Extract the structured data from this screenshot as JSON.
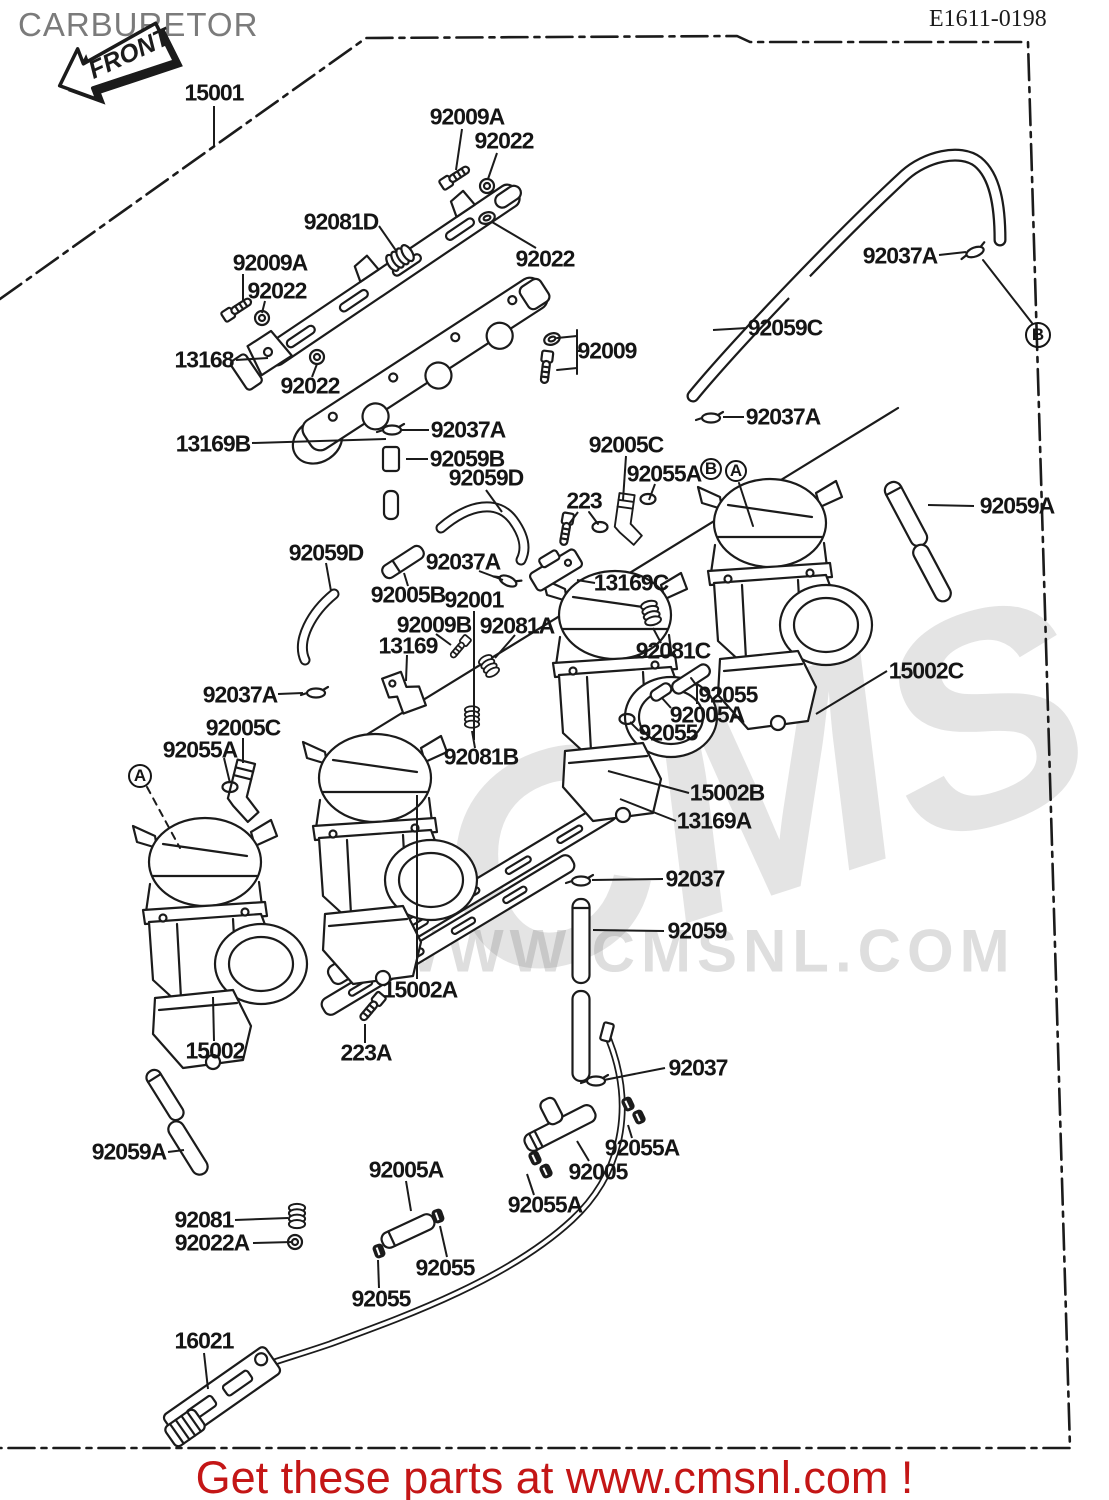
{
  "header": {
    "title": "CARBURETOR",
    "title_color": "#7b7b7b",
    "diagram_code": "E1611-0198"
  },
  "front_arrow": {
    "label": "FRONT"
  },
  "watermark": {
    "logo_text": "CMS",
    "url_text": "WWW.CMSNL.COM",
    "color": "#c9c9c9"
  },
  "footer": {
    "text": "Get these parts at www.cmsnl.com !",
    "color": "#c41616"
  },
  "colors": {
    "line": "#1b1b1b",
    "label": "#151515",
    "background": "#ffffff"
  },
  "diagram": {
    "reference_markers": [
      {
        "label": "A",
        "x": 140,
        "y": 776,
        "d": 24
      },
      {
        "label": "B",
        "x": 711,
        "y": 469,
        "d": 22
      },
      {
        "label": "A",
        "x": 736,
        "y": 471,
        "d": 22
      },
      {
        "label": "B",
        "x": 1038,
        "y": 335,
        "d": 26
      }
    ],
    "part_labels": [
      {
        "t": "15001",
        "x": 214,
        "y": 93,
        "l": [
          214,
          106,
          214,
          147
        ]
      },
      {
        "t": "92009A",
        "x": 467,
        "y": 117,
        "l": [
          462,
          129,
          456,
          170
        ]
      },
      {
        "t": "92022",
        "x": 504,
        "y": 141,
        "l": [
          497,
          153,
          488,
          179
        ]
      },
      {
        "t": "92022",
        "x": 545,
        "y": 259,
        "l": [
          536,
          248,
          492,
          222
        ]
      },
      {
        "t": "92081D",
        "x": 341,
        "y": 222,
        "l": [
          379,
          226,
          397,
          252
        ]
      },
      {
        "t": "92009A",
        "x": 270,
        "y": 263,
        "l": [
          243,
          274,
          243,
          302
        ]
      },
      {
        "t": "92022",
        "x": 277,
        "y": 291,
        "l": [
          265,
          301,
          262,
          313
        ]
      },
      {
        "t": "13168",
        "x": 204,
        "y": 360,
        "l": [
          236,
          360,
          268,
          358
        ]
      },
      {
        "t": "92022",
        "x": 310,
        "y": 386,
        "l": [
          312,
          377,
          317,
          364
        ]
      },
      {
        "t": "13169B",
        "x": 213,
        "y": 444,
        "l": [
          252,
          443,
          386,
          439
        ]
      },
      {
        "t": "92009",
        "x": 607,
        "y": 351,
        "l": [
          581,
          351,
          577,
          351
        ]
      },
      {
        "t": "92037A",
        "x": 468,
        "y": 430,
        "l": [
          429,
          430,
          401,
          430
        ]
      },
      {
        "t": "92059B",
        "x": 467,
        "y": 459,
        "l": [
          428,
          459,
          406,
          459
        ]
      },
      {
        "t": "92059D",
        "x": 486,
        "y": 478,
        "l": [
          486,
          490,
          502,
          512
        ]
      },
      {
        "t": "223",
        "x": 584,
        "y": 501,
        "l": [
          578,
          512,
          569,
          524
        ]
      },
      {
        "t": "92059D",
        "x": 326,
        "y": 553,
        "l": [
          326,
          563,
          331,
          591
        ]
      },
      {
        "t": "92037A",
        "x": 463,
        "y": 562,
        "l": [
          479,
          571,
          503,
          580
        ]
      },
      {
        "t": "92005B",
        "x": 408,
        "y": 595,
        "l": [
          408,
          586,
          404,
          573
        ]
      },
      {
        "t": "92001",
        "x": 474,
        "y": 600,
        "l": [
          474,
          611,
          474,
          740
        ]
      },
      {
        "t": "92009B",
        "x": 434,
        "y": 625,
        "l": [
          436,
          634,
          451,
          645
        ]
      },
      {
        "t": "92081A",
        "x": 517,
        "y": 626,
        "l": [
          515,
          635,
          495,
          658
        ]
      },
      {
        "t": "13169",
        "x": 408,
        "y": 646,
        "l": [
          407,
          655,
          406,
          681
        ]
      },
      {
        "t": "92081C",
        "x": 673,
        "y": 651,
        "l": [
          661,
          643,
          653,
          628
        ]
      },
      {
        "t": "92055",
        "x": 728,
        "y": 695,
        "l": [
          697,
          704,
          697,
          686
        ]
      },
      {
        "t": "92005A",
        "x": 707,
        "y": 715,
        "l": [
          671,
          708,
          662,
          698
        ]
      },
      {
        "t": "92055",
        "x": 668,
        "y": 733,
        "l": [
          639,
          731,
          630,
          722
        ]
      },
      {
        "t": "92081B",
        "x": 481,
        "y": 757,
        "l": [
          475,
          748,
          472,
          731
        ]
      },
      {
        "t": "15002B",
        "x": 727,
        "y": 793,
        "l": [
          689,
          793,
          608,
          771
        ]
      },
      {
        "t": "13169A",
        "x": 714,
        "y": 821,
        "l": [
          676,
          821,
          620,
          799
        ]
      },
      {
        "t": "92037",
        "x": 695,
        "y": 879,
        "l": [
          663,
          879,
          592,
          880
        ]
      },
      {
        "t": "92059",
        "x": 697,
        "y": 931,
        "l": [
          664,
          931,
          593,
          930
        ]
      },
      {
        "t": "15002A",
        "x": 420,
        "y": 990,
        "l": [
          417,
          979,
          417,
          795
        ]
      },
      {
        "t": "92037A",
        "x": 240,
        "y": 695,
        "l": [
          278,
          694,
          303,
          693
        ]
      },
      {
        "t": "92005C",
        "x": 243,
        "y": 728,
        "l": [
          243,
          738,
          243,
          763
        ]
      },
      {
        "t": "92055A",
        "x": 200,
        "y": 750,
        "l": [
          224,
          758,
          230,
          783
        ]
      },
      {
        "t": "15002",
        "x": 215,
        "y": 1051,
        "l": [
          214,
          1041,
          213,
          997
        ]
      },
      {
        "t": "223A",
        "x": 366,
        "y": 1053,
        "l": [
          365,
          1043,
          365,
          1024
        ]
      },
      {
        "t": "92059A",
        "x": 129,
        "y": 1152,
        "l": [
          168,
          1152,
          184,
          1150
        ]
      },
      {
        "t": "92081",
        "x": 204,
        "y": 1220,
        "l": [
          235,
          1220,
          288,
          1218
        ]
      },
      {
        "t": "92022A",
        "x": 212,
        "y": 1243,
        "l": [
          253,
          1243,
          292,
          1242
        ]
      },
      {
        "t": "92005A",
        "x": 406,
        "y": 1170,
        "l": [
          406,
          1181,
          411,
          1211
        ]
      },
      {
        "t": "92055",
        "x": 445,
        "y": 1268,
        "l": [
          447,
          1257,
          440,
          1226
        ]
      },
      {
        "t": "92055",
        "x": 381,
        "y": 1299,
        "l": [
          379,
          1288,
          378,
          1260
        ]
      },
      {
        "t": "16021",
        "x": 204,
        "y": 1341,
        "l": [
          204,
          1353,
          208,
          1389
        ]
      },
      {
        "t": "92005",
        "x": 598,
        "y": 1172,
        "l": [
          589,
          1161,
          577,
          1141
        ]
      },
      {
        "t": "92055A",
        "x": 642,
        "y": 1148,
        "l": [
          632,
          1138,
          628,
          1125
        ]
      },
      {
        "t": "92055A",
        "x": 545,
        "y": 1205,
        "l": [
          534,
          1195,
          527,
          1174
        ]
      },
      {
        "t": "92037",
        "x": 698,
        "y": 1068,
        "l": [
          665,
          1068,
          604,
          1080
        ]
      },
      {
        "t": "92059C",
        "x": 785,
        "y": 328,
        "l": [
          747,
          328,
          713,
          330
        ]
      },
      {
        "t": "92037A",
        "x": 783,
        "y": 417,
        "l": [
          744,
          417,
          723,
          417
        ]
      },
      {
        "t": "92005C",
        "x": 626,
        "y": 445,
        "l": [
          626,
          456,
          623,
          500
        ]
      },
      {
        "t": "92055A",
        "x": 664,
        "y": 474,
        "l": [
          655,
          484,
          649,
          500
        ]
      },
      {
        "t": "13169C",
        "x": 631,
        "y": 583,
        "l": [
          595,
          583,
          577,
          580
        ]
      },
      {
        "t": "92059A",
        "x": 1017,
        "y": 506,
        "l": [
          974,
          506,
          928,
          505
        ]
      },
      {
        "t": "15002C",
        "x": 926,
        "y": 671,
        "l": [
          887,
          671,
          816,
          714
        ]
      },
      {
        "t": "92037A",
        "x": 900,
        "y": 256,
        "l": [
          939,
          255,
          966,
          252
        ]
      }
    ]
  }
}
